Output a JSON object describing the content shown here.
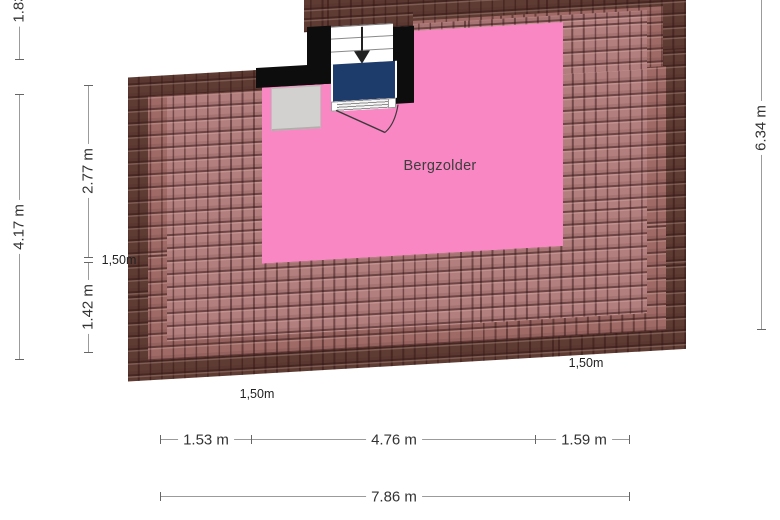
{
  "plan": {
    "room": {
      "label": "Bergzolder"
    },
    "colors": {
      "room_fill": "#f987c4",
      "roof_dark": "#5e3b33",
      "roof_mid": "#9f6a66",
      "roof_light": "#b37e7e",
      "landing_blue": "#1d3c6b",
      "wall_black": "#0d0d0d",
      "cabinet_gray": "#d3d1cf",
      "dim_line": "#9b9b9b",
      "text": "#333333"
    }
  },
  "dimensions": {
    "left_outer": {
      "top": "1.83",
      "bottom": "4.17 m"
    },
    "left_inner": {
      "top": "2.77 m",
      "bottom": "1.42 m"
    },
    "right": "6.34 m",
    "bottom_segments": [
      "1.53 m",
      "4.76 m",
      "1.59 m"
    ],
    "bottom_total": "7.86 m",
    "eave_left": "1,50m",
    "eave_bottom_left": "1,50m",
    "eave_bottom_right": "1,50m"
  }
}
